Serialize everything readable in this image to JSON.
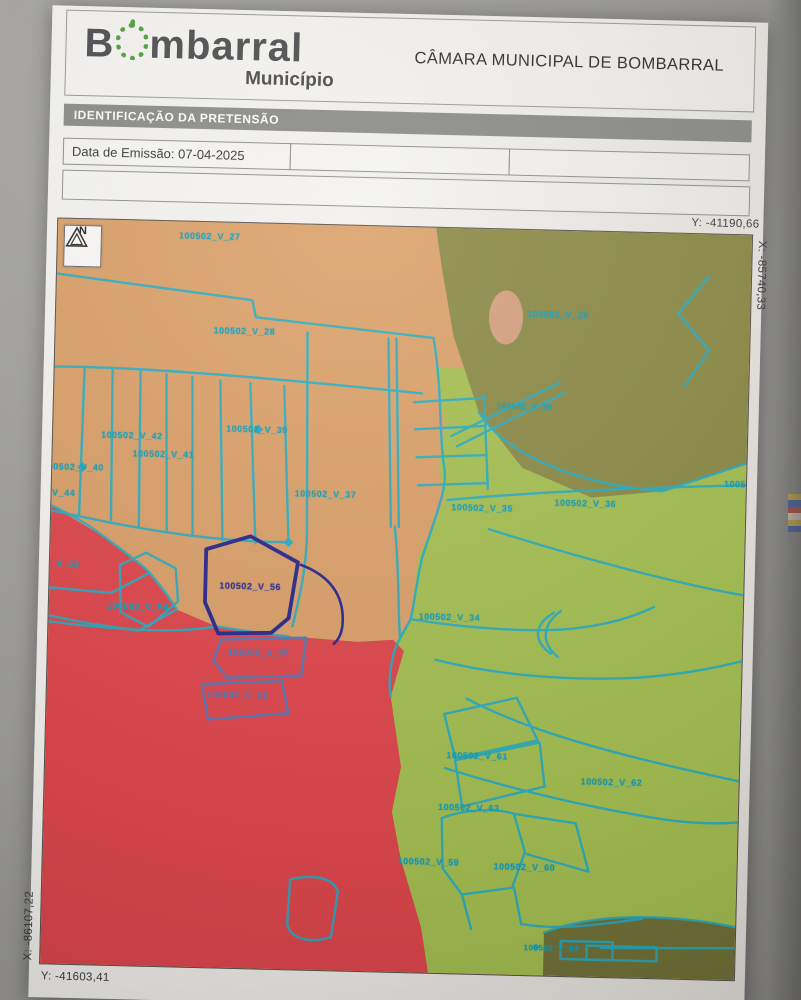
{
  "header": {
    "brand_pre": "B",
    "brand_post": "mbarral",
    "brand_sub": "Município",
    "title": "CÂMARA MUNICIPAL DE BOMBARRAL"
  },
  "section_bar": {
    "label": "IDENTIFICAÇÃO DA PRETENSÃO"
  },
  "form": {
    "emission": "Data de Emissão: 07-04-2025"
  },
  "map": {
    "north_label": "N",
    "coordinates": {
      "top_right_y": "Y: -41190,66",
      "right_x": "X: -85740,33",
      "left_x": "X: -86107,22",
      "bottom_y": "Y: -41603,41"
    },
    "colors": {
      "orange_zone": "#dca26b",
      "olive_zone": "#8d8c48",
      "green_zone": "#a7c153",
      "red_zone": "#e0484e",
      "salmon_patch": "#e3a58c",
      "parcel_line_cyan": "#2aaec4",
      "highlight_navy": "#2b2b8f",
      "outline_steel": "#5b79b6"
    },
    "parcels": [
      {
        "label": "100502_V_27",
        "x": 121,
        "y": 9,
        "style": "cyan"
      },
      {
        "label": "100502_V_28",
        "x": 158,
        "y": 103,
        "style": "cyan"
      },
      {
        "label": "100502_V_26",
        "x": 471,
        "y": 79,
        "style": "cyan"
      },
      {
        "label": "100502_V_39",
        "x": 173,
        "y": 201,
        "style": "cyan"
      },
      {
        "label": "100502_V_42",
        "x": 48,
        "y": 210,
        "style": "cyan"
      },
      {
        "label": "100502_V_41",
        "x": 80,
        "y": 228,
        "style": "cyan"
      },
      {
        "label": "100502_V_40",
        "x": -10,
        "y": 243,
        "style": "cyan"
      },
      {
        "label": "100502_V_44",
        "x": -38,
        "y": 269,
        "style": "cyan"
      },
      {
        "label": "100502_V_37",
        "x": 243,
        "y": 264,
        "style": "cyan"
      },
      {
        "label": "100502_V_35",
        "x": 400,
        "y": 274,
        "style": "cyan"
      },
      {
        "label": "100502_V_36",
        "x": 503,
        "y": 267,
        "style": "cyan"
      },
      {
        "label": "100502_V_30",
        "x": 443,
        "y": 172,
        "style": "cyan-small"
      },
      {
        "label": "100502_V_31",
        "x": 672,
        "y": 244,
        "style": "cyan"
      },
      {
        "label": "100502_V_53",
        "x": -32,
        "y": 340,
        "style": "cyan"
      },
      {
        "label": "100502_V_54",
        "x": 58,
        "y": 381,
        "style": "cyan"
      },
      {
        "label": "100502_V_56",
        "x": 170,
        "y": 358,
        "style": "navy"
      },
      {
        "label": "100502_V_57",
        "x": 180,
        "y": 424,
        "style": "steel"
      },
      {
        "label": "100502_V_58",
        "x": 160,
        "y": 467,
        "style": "steel"
      },
      {
        "label": "100502_V_34",
        "x": 370,
        "y": 384,
        "style": "cyan"
      },
      {
        "label": "100502_V_61",
        "x": 401,
        "y": 522,
        "style": "cyan"
      },
      {
        "label": "100502_V_62",
        "x": 536,
        "y": 545,
        "style": "cyan"
      },
      {
        "label": "100502_V_63",
        "x": 394,
        "y": 574,
        "style": "cyan"
      },
      {
        "label": "100502_V_59",
        "x": 355,
        "y": 629,
        "style": "cyan"
      },
      {
        "label": "100502_V_60",
        "x": 451,
        "y": 632,
        "style": "cyan"
      },
      {
        "label": "100502_V_64",
        "x": 483,
        "y": 713,
        "style": "cyan-small"
      }
    ]
  }
}
